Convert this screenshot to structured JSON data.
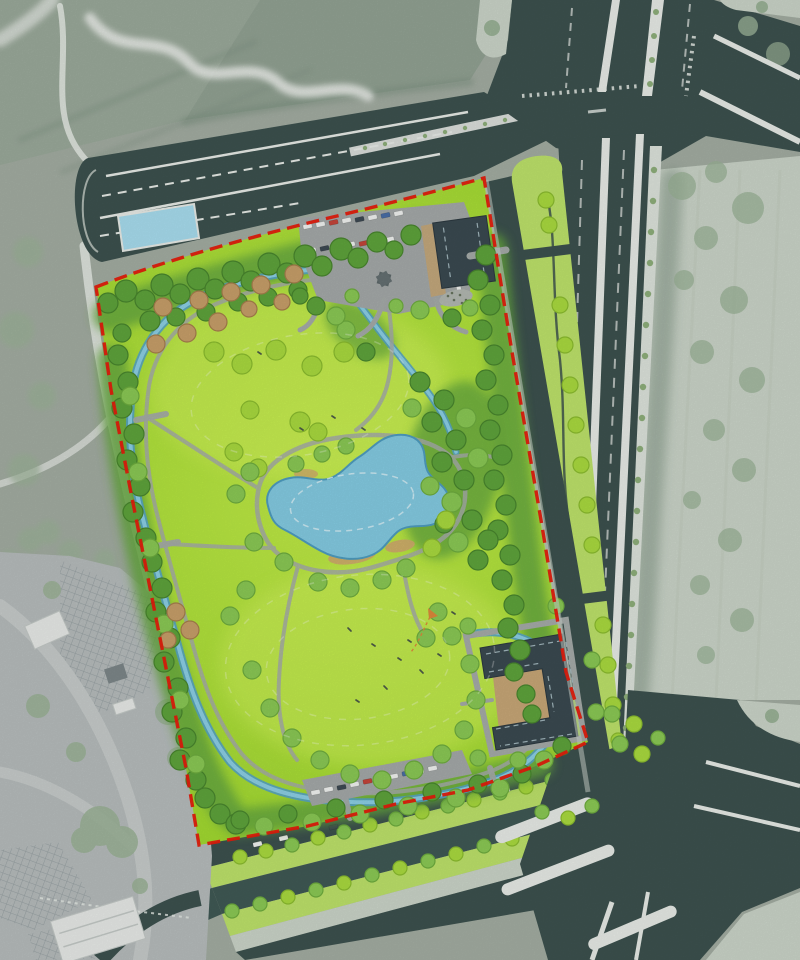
{
  "canvas": {
    "width": 800,
    "height": 960
  },
  "map": {
    "kind": "landscape-architecture-site-plan-over-aerial-photo",
    "visible_text": [],
    "legend": []
  },
  "features": {
    "park": [
      "red-dashed-site-boundary",
      "north-great-lawn",
      "south-great-lawn",
      "central-pond",
      "looping-stream",
      "perimeter-tree-belts",
      "north-entrance-parking",
      "north-service-building",
      "east-courtyard-building",
      "south-parking-lot",
      "pavilion",
      "rockery",
      "lawn-contour-lines",
      "visitor-figures",
      "kite-play-area"
    ],
    "context": [
      "north-frontage-road-with-layby-pool",
      "arterial-road-bundle-east",
      "tree-planted-median-wedge",
      "street-tree-row",
      "intersection-northeast",
      "intersection-southeast",
      "south-road-and-canal",
      "tree-lined-parking-strips-south",
      "west-transit-plaza",
      "farm-fields-northwest",
      "meandering-creek-northwest",
      "pale-open-ground-east"
    ]
  },
  "colors": {
    "sat": "#a4aea3",
    "satField1": "#9cab9c",
    "satField2": "#93a394",
    "pale": "#ccd6ca",
    "paleLine": "#c2cdc0",
    "hedge": "#7c9180",
    "road": "#3d524f",
    "canal": "#405a55",
    "laneWhite": "#e9ede8",
    "sidewalk": "#ccd3cc",
    "medianGreen": "#bfe46b",
    "streetTreeStrip": "#dfe5dd",
    "streetTreeDot": "#8fb07c",
    "lawnCore": "#c3ee49",
    "lawnEdge": "#9fd92e",
    "lawnHi": "#d2f45c",
    "beltGreen": "#66a93f",
    "treeDark": "#5fa53c",
    "treeDarkEdge": "#49872e",
    "treeLight": "#8ccb55",
    "treeLightEdge": "#6fae3f",
    "treeYellow": "#abdc3f",
    "treeYellowEdge": "#8cbe2f",
    "treeTan": "#c9a06a",
    "treeTanEdge": "#a87f4d",
    "treeSat": "#9cb498",
    "water": "#57a6c8",
    "waterCore": "#90d3ea",
    "pond": "#85cde4",
    "pondEdge": "#4f9ec2",
    "pondInner": "#d8f1f8",
    "sand": "#d2ab6e",
    "pool": "#a9def0",
    "plaza": "#b8bebe",
    "plazaHatch": "#9aa3a5",
    "plazaRoad": "#c8cdcc",
    "lot": "#a6abaa",
    "path": "#a7adaa",
    "roof": "#3b4a51",
    "roofEdge": "#2c3940",
    "ridge": "#a3b8be",
    "court": "#c9a878",
    "whiteRoof": "#e9ece9",
    "whiteRoofEdge": "#c5cbc8",
    "boundary": "#e81c0c",
    "carWhite": "#f3f5f3",
    "carDark": "#3e4a54",
    "carRed": "#c6453a",
    "carBlue": "#4a6fa8",
    "figure": "#4e5c49",
    "kite": "#e08a3c"
  }
}
